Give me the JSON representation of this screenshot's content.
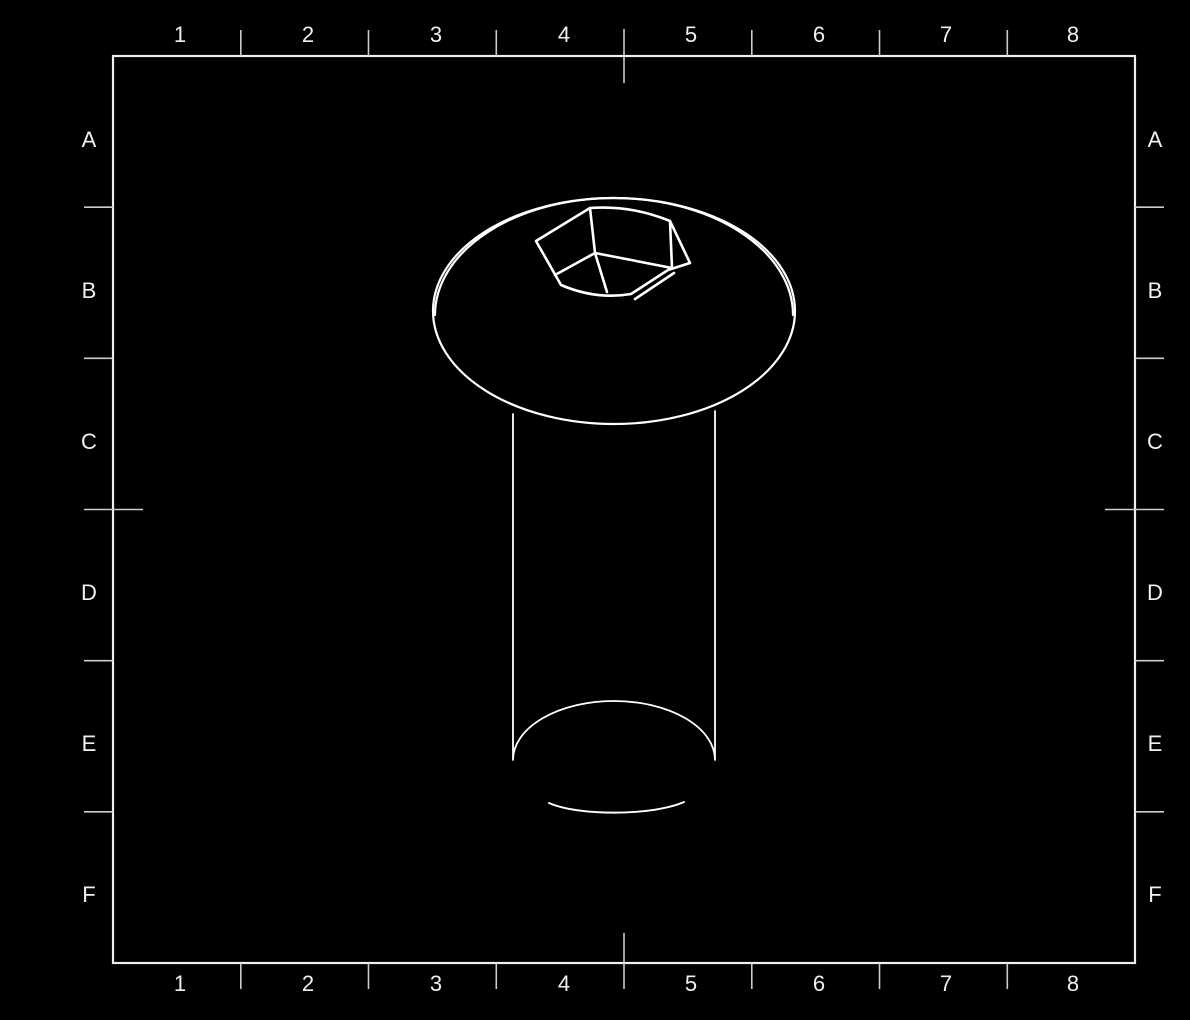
{
  "zones": {
    "columns": [
      "1",
      "2",
      "3",
      "4",
      "5",
      "6",
      "7",
      "8"
    ],
    "rows": [
      "A",
      "B",
      "C",
      "D",
      "E",
      "F"
    ]
  },
  "drawing": {
    "subject": "button-head-hex-socket-screw",
    "view": "isometric"
  },
  "colors": {
    "background": "#000000",
    "border": "#f0f0f0",
    "ticks": "#cccccc",
    "labels": "#f0f0f0",
    "drawing_lines": "#ffffff"
  }
}
